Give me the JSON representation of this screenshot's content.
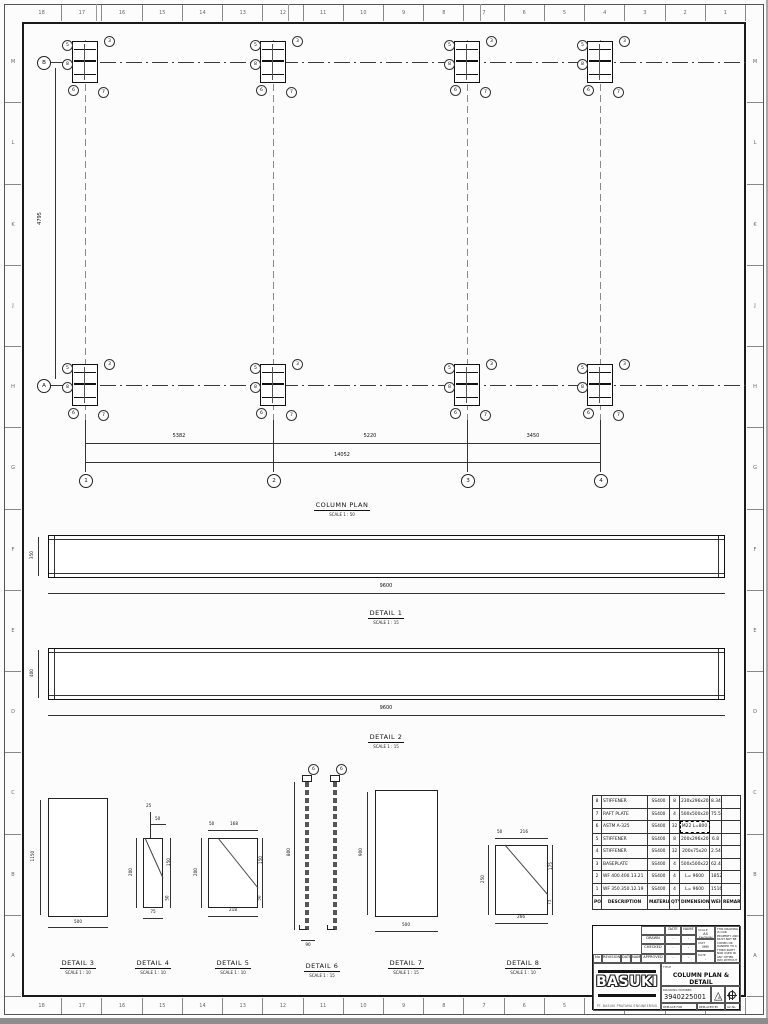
{
  "sheet": {
    "top_numbers": [
      "18",
      "17",
      "16",
      "15",
      "14",
      "13",
      "12",
      "11",
      "10",
      "9",
      "8",
      "7",
      "6",
      "5",
      "4",
      "3",
      "2",
      "1"
    ],
    "side_letters": [
      "M",
      "L",
      "K",
      "J",
      "H",
      "G",
      "F",
      "E",
      "D",
      "C",
      "B",
      "A"
    ]
  },
  "plan": {
    "title": "COLUMN PLAN",
    "scale": "SCALE 1 : 50",
    "dim_left": "4795",
    "span_dims": [
      "5382",
      "5220",
      "3450"
    ],
    "total_dim": "14052",
    "col_bubbles": [
      "1",
      "2",
      "3",
      "4"
    ],
    "row_bubbles": [
      "B",
      "A"
    ],
    "columns_x": [
      85,
      273,
      467,
      600
    ],
    "rows_y": [
      62,
      385
    ],
    "balloons": [
      {
        "dx": -23,
        "dy": -22,
        "t": "5"
      },
      {
        "dx": 19,
        "dy": -26,
        "t": "3"
      },
      {
        "dx": -23,
        "dy": -3,
        "t": "8"
      },
      {
        "dx": -17,
        "dy": 23,
        "t": "6"
      },
      {
        "dx": 13,
        "dy": 25,
        "t": "7"
      }
    ]
  },
  "details": {
    "d1": {
      "label": "DETAIL 1",
      "scale": "SCALE 1 : 15",
      "dim_left": "350",
      "dim_bottom": "9600"
    },
    "d2": {
      "label": "DETAIL 2",
      "scale": "SCALE 1 : 15",
      "dim_left": "400",
      "dim_bottom": "9600"
    },
    "d3": {
      "label": "DETAIL 3",
      "scale": "SCALE 1 : 10",
      "dim_left": "1150",
      "dim_bottom": "500"
    },
    "d4": {
      "label": "DETAIL 4",
      "scale": "SCALE 1 : 10",
      "top1": "25",
      "top2": "50",
      "right1": "150",
      "right2": "50",
      "left": "200",
      "bottom": "75"
    },
    "d5": {
      "label": "DETAIL 5",
      "scale": "SCALE 1 : 10",
      "top1": "50",
      "top2": "168",
      "right1": "150",
      "right2": "50",
      "left": "200",
      "bottom": "218"
    },
    "d6": {
      "label": "DETAIL 6",
      "scale": "SCALE 1 : 15",
      "dim_left": "800",
      "dim_bottom": "90",
      "balloon": "6"
    },
    "d7": {
      "label": "DETAIL 7",
      "scale": "SCALE 1 : 15",
      "dim_left": "900",
      "dim_bottom": "500"
    },
    "d8": {
      "label": "DETAIL 8",
      "scale": "SCALE 1 : 10",
      "top1": "50",
      "top2": "216",
      "right1": "175",
      "right2": "75",
      "left": "250",
      "bottom": "266"
    }
  },
  "material_table": {
    "headers": [
      "POS",
      "DESCRIPTION",
      "MATERIAL",
      "QTY",
      "DIMENSIONS",
      "WEIGHT",
      "REMARK"
    ],
    "rows": [
      {
        "pos": "8",
        "description": "STIFFENER",
        "material": "SS400",
        "qty": "8",
        "dimensions": "230x296x20",
        "weight": "8.34",
        "remark": "",
        "highlight": false
      },
      {
        "pos": "7",
        "description": "RAFT PLATE",
        "material": "SS400",
        "qty": "4",
        "dimensions": "500x500x20",
        "weight": "75.5",
        "remark": "",
        "highlight": false
      },
      {
        "pos": "6",
        "description": "ASTM A-325",
        "material": "SS400",
        "qty": "32",
        "dimensions": "M22 L=800",
        "weight": "",
        "remark": "",
        "highlight": true
      },
      {
        "pos": "5",
        "description": "STIFFENER",
        "material": "SS400",
        "qty": "8",
        "dimensions": "200x296x20",
        "weight": "6.8",
        "remark": "",
        "highlight": false
      },
      {
        "pos": "4",
        "description": "STIFFENER",
        "material": "SS400",
        "qty": "32",
        "dimensions": "200x75x20",
        "weight": "2.54",
        "remark": "",
        "highlight": false
      },
      {
        "pos": "3",
        "description": "BASEPLATE",
        "material": "SS400",
        "qty": "4",
        "dimensions": "500x500x22",
        "weight": "62.4",
        "remark": "",
        "highlight": false
      },
      {
        "pos": "2",
        "description": "WF 400.400.13.21",
        "material": "SS400",
        "qty": "4",
        "dimensions": "L= 9600",
        "weight": "1852",
        "remark": "",
        "highlight": false
      },
      {
        "pos": "1",
        "description": "WF 350.350.12.19",
        "material": "SS400",
        "qty": "4",
        "dimensions": "L= 9600",
        "weight": "1516",
        "remark": "",
        "highlight": false
      }
    ]
  },
  "title_block": {
    "date_header": "DATE",
    "name_header": "NAME",
    "drawn_label": "DRAWN",
    "drawn_date": "-",
    "drawn_name": "-",
    "checked_label": "CHECKED",
    "checked_date": "-",
    "checked_name": "-",
    "approved_label": "APPROVED",
    "approved_date": "-",
    "approved_name": "-",
    "rev_no_header": "No",
    "rev_header": "REVISION",
    "rev_date_header": "DATE",
    "rev_name_header": "NAME",
    "scale_label": "SCALE",
    "scale_value": "AS SHOWN",
    "unit_label": "UNIT",
    "unit_value": "MM",
    "date_label": "DATE",
    "date_value": "-",
    "note": "THIS DRAWING IS OUR PROPERTY AND MUST NOT BE COPIED OR HANDED TO A THIRD PARTY NOR USED IN ANY OTHER WAY WITHOUT OUR WRITTEN CONSENT",
    "company": "BASUKI",
    "company_sub": "PT. BASUKI PRATAMA ENGINEERING",
    "title_label": "TITLE",
    "title_value": "COLUMN PLAN & DETAIL",
    "drawing_number_label": "DRAWING NUMBER",
    "drawing_number": "3940225001",
    "revision_letter": "A",
    "footer_left": "REPLACE FOR",
    "footer_mid": "REPLACED BY",
    "footer_right": "A2 No."
  }
}
